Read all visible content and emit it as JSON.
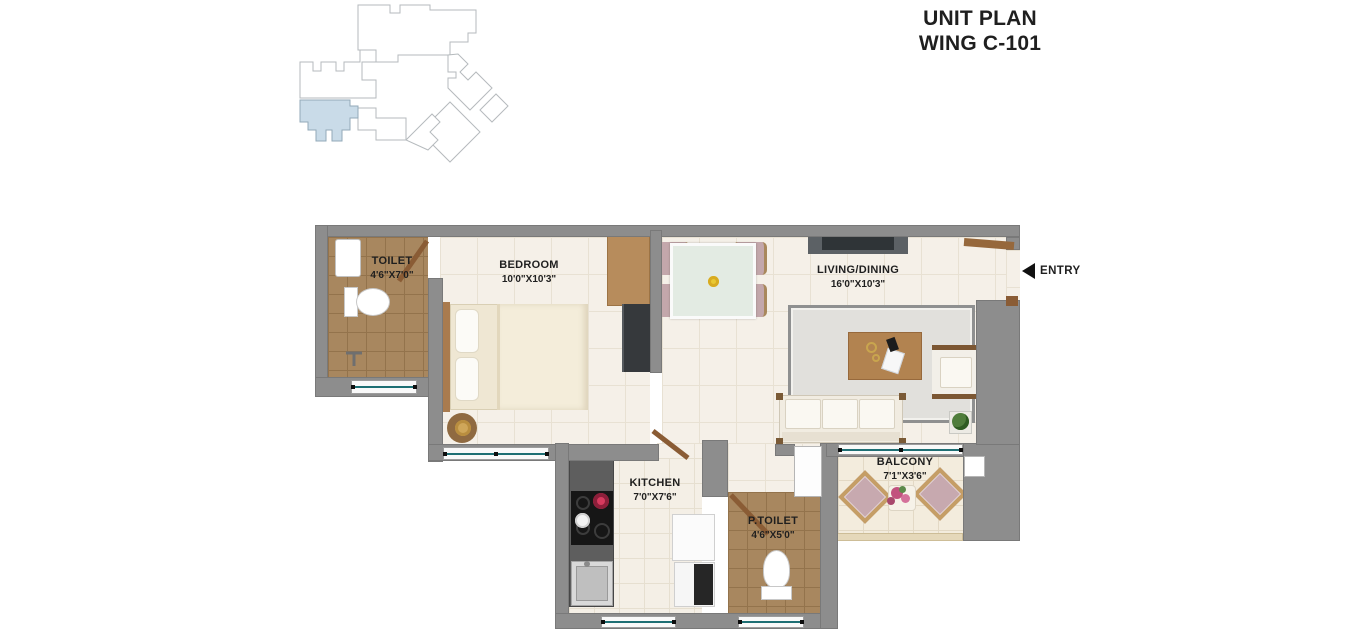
{
  "title": {
    "line1": "UNIT PLAN",
    "line2": "WING C-101"
  },
  "entry": {
    "label": "ENTRY"
  },
  "rooms": {
    "toilet": {
      "name": "TOILET",
      "dims": "4'6\"X7'0\""
    },
    "bedroom": {
      "name": "BEDROOM",
      "dims": "10'0\"X10'3\""
    },
    "living_dining": {
      "name": "LIVING/DINING",
      "dims": "16'0\"X10'3\""
    },
    "kitchen": {
      "name": "KITCHEN",
      "dims": "7'0\"X7'6\""
    },
    "p_toilet": {
      "name": "P.TOILET",
      "dims": "4'6\"X5'0\""
    },
    "balcony": {
      "name": "BALCONY",
      "dims": "7'1\"X3'6\""
    }
  },
  "keyplan": {
    "highlight_color": "#c9dbe8"
  },
  "colors": {
    "wall": "#8d8d8d",
    "floor": "#f5f0e8",
    "bath_floor": "#a8875f",
    "window_glass": "#1e6f74",
    "door_wood": "#8a5c35",
    "text": "#1f1f1f"
  }
}
